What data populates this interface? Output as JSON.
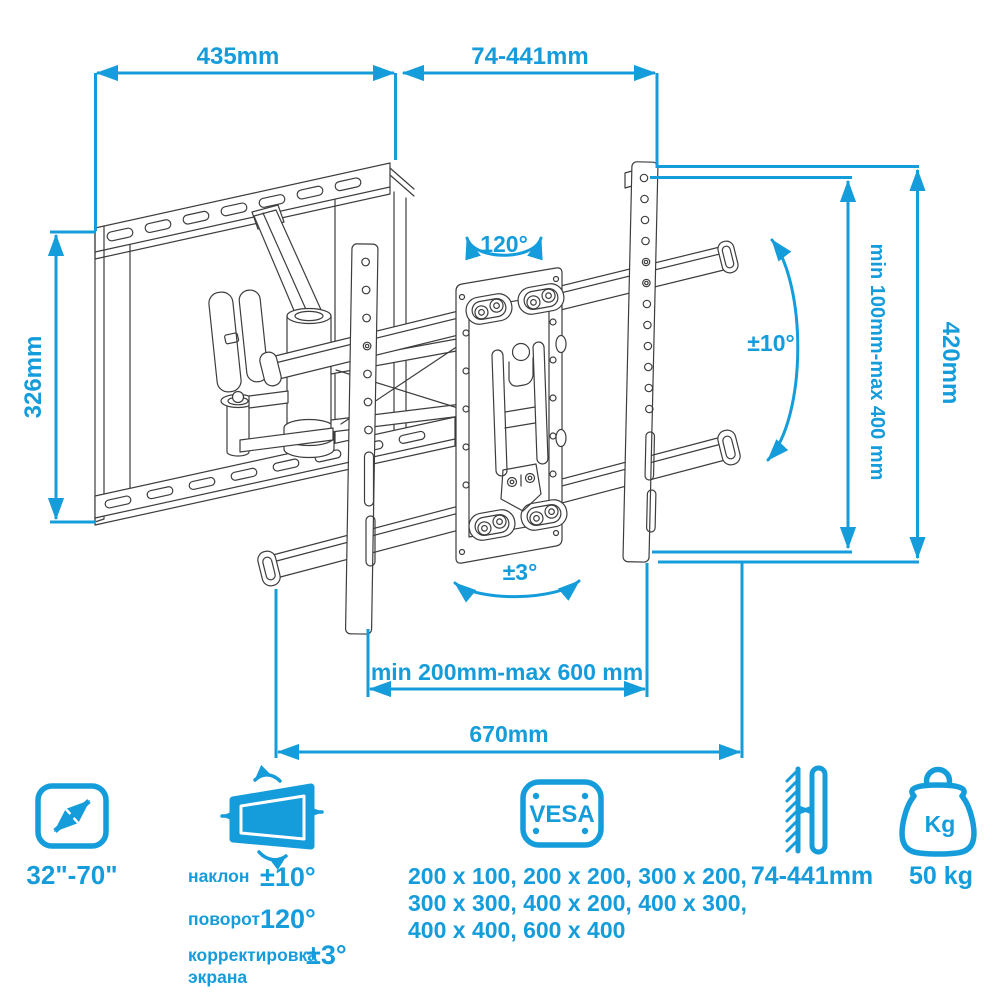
{
  "colors": {
    "accent": "#149CDB",
    "line_art": "#3D3D3D",
    "background": "#FFFFFF"
  },
  "annotations": {
    "top_width": "435mm",
    "extension_range": "74-441mm",
    "plate_height": "326mm",
    "bracket_height": "420mm",
    "vesa_vertical_range": "min 100mm-max 400 mm",
    "swivel_angle": "120°",
    "tilt_angle": "±10°",
    "screen_level_angle": "±3°",
    "rail_span_range": "min 200mm-max 600 mm",
    "total_width": "670mm"
  },
  "legend": {
    "screen_size": {
      "value": "32\"-70\""
    },
    "movement": {
      "tilt_label": "наклон",
      "tilt_value": "±10°",
      "swivel_label": "поворот",
      "swivel_value": "120°",
      "adjust_label_line1": "корректировка",
      "adjust_label_line2": "экрана",
      "adjust_value": "±3°"
    },
    "vesa": {
      "title": "VESA",
      "sizes_line1": "200 x 100, 200 x 200, 300 x 200,",
      "sizes_line2": "300 x 300, 400 x 200, 400 x 300,",
      "sizes_line3": "400 x 400, 600 x 400"
    },
    "wall_distance": {
      "value": "74-441mm"
    },
    "max_weight": {
      "badge": "Kg",
      "value": "50 kg"
    }
  }
}
